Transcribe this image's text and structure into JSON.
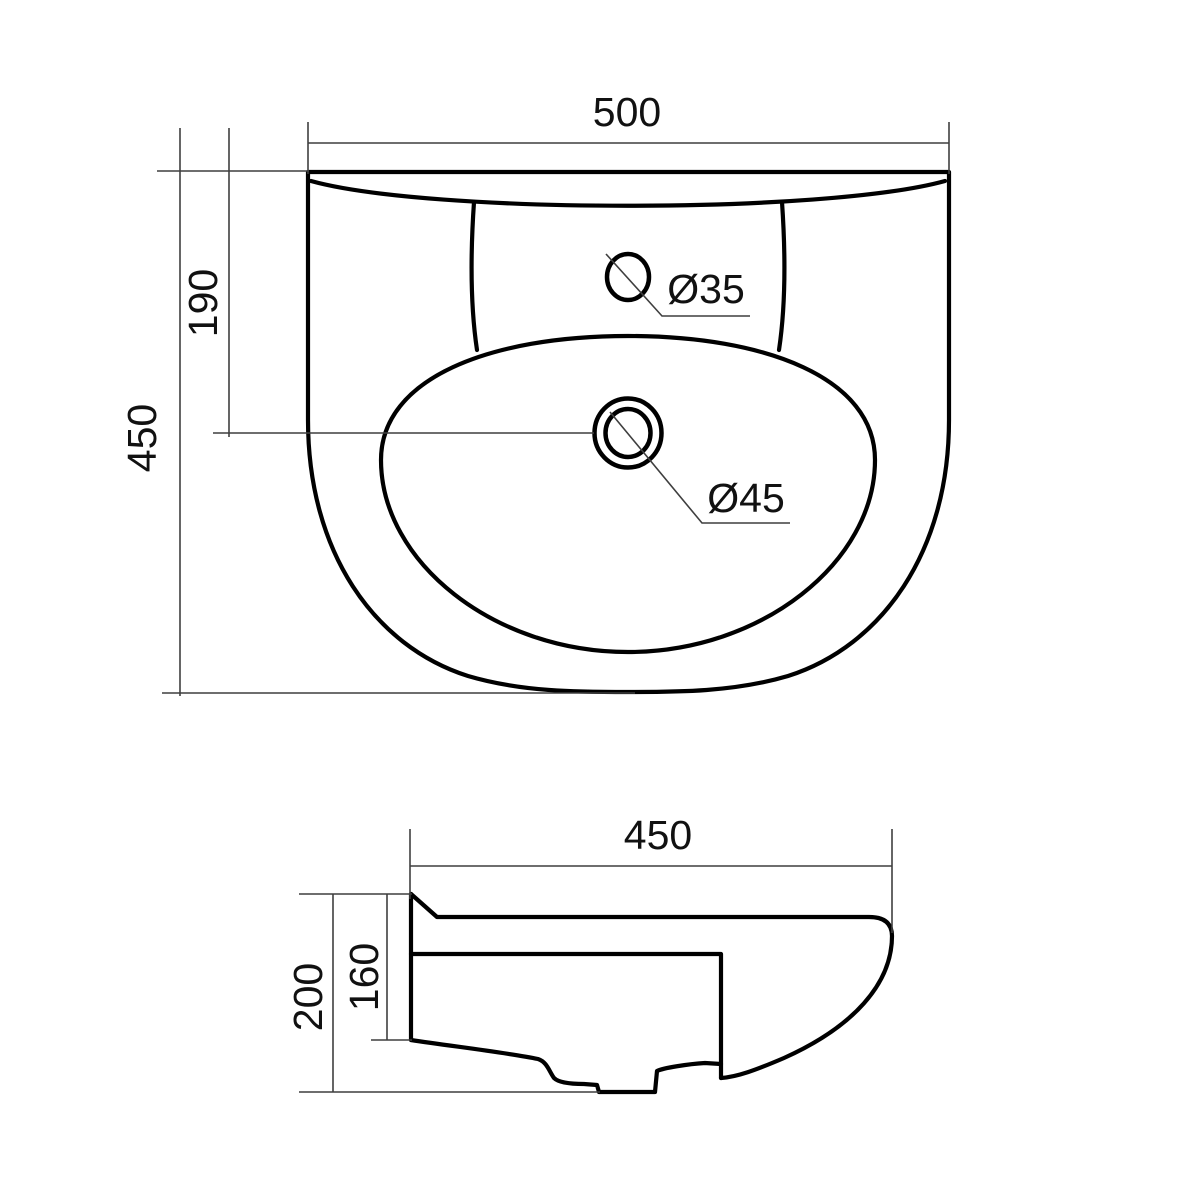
{
  "canvas": {
    "background": "#ffffff",
    "outline_color": "#000000",
    "dimension_line_color": "#3f3f3f",
    "text_color": "#111111"
  },
  "drawing": {
    "type": "washbasin-technical-drawing",
    "top_view": {
      "dim_width": "500",
      "dim_depth": "450",
      "dim_tap_offset": "190",
      "label_tap_hole": "Ø35",
      "label_drain": "Ø45"
    },
    "side_view": {
      "dim_depth": "450",
      "dim_height": "200",
      "dim_inner_height": "160"
    }
  }
}
